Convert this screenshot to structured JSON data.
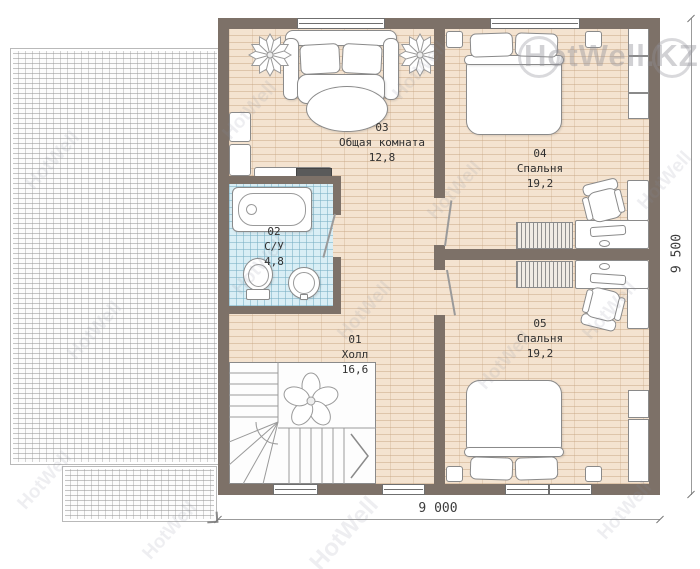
{
  "watermark": {
    "brand": "HotWell.KZ",
    "tile": "HotWell"
  },
  "plan": {
    "rooms": {
      "r01": {
        "number": "01",
        "name": "Холл",
        "area": "16,6"
      },
      "r02": {
        "number": "02",
        "name": "С/У",
        "area": "4,8"
      },
      "r03": {
        "number": "03",
        "name": "Общая комната",
        "area": "12,8"
      },
      "r04": {
        "number": "04",
        "name": "Спальня",
        "area": "19,2"
      },
      "r05": {
        "number": "05",
        "name": "Спальня",
        "area": "19,2"
      }
    },
    "dimensions": {
      "width": "9 000",
      "height": "9 500"
    }
  },
  "symbols": {
    "sofa": "three-seat sofa",
    "coffee-table": "oval table",
    "plant": "potted plant",
    "bathtub": "bathtub",
    "toilet": "toilet",
    "sink": "round sink",
    "stairs": "L-shaped staircase",
    "bed": "double bed",
    "nightstand": "nightstand",
    "wardrobe": "wardrobe",
    "closet": "hatched closet",
    "desk": "desk",
    "office-chair": "office chair",
    "keyboard": "keyboard",
    "mouse": "mouse",
    "tv": "tv-set"
  },
  "colors": {
    "wall": "#7d7168",
    "floor": "#f4e3d0",
    "tiles": "#d9eef5",
    "dimension_text": "#3c3c3c"
  }
}
